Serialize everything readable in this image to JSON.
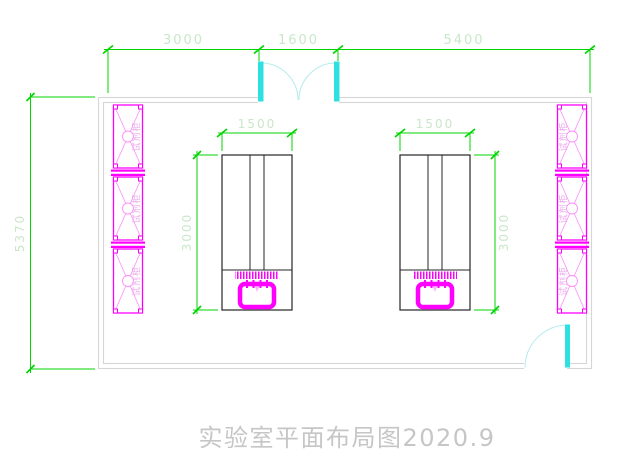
{
  "title": {
    "text": "实验室平面布局图2020.9"
  },
  "dimensions": {
    "top": [
      "3000",
      "1600",
      "5400"
    ],
    "left_wall": "5370",
    "bench_width_left": "1500",
    "bench_width_right": "1500",
    "bench_depth_left": "3000",
    "bench_depth_right": "3000"
  },
  "cabinets": {
    "left": [
      "试剂柜",
      "试剂柜",
      "试剂柜"
    ],
    "right": [
      "试剂柜",
      "试剂柜",
      "试剂柜"
    ]
  },
  "colors": {
    "dimension-line": "#00d400",
    "dimension-text": "#c9e7c9",
    "cabinet-line": "#ff00ff",
    "cabinet-text": "#eaaaea",
    "door": "#2ee0e0",
    "door-arc": "#b5ecec",
    "wall": "#d6d6d6",
    "bench-line": "#262626",
    "sink": "#ff00ff",
    "title-text": "#c6c6c6"
  }
}
